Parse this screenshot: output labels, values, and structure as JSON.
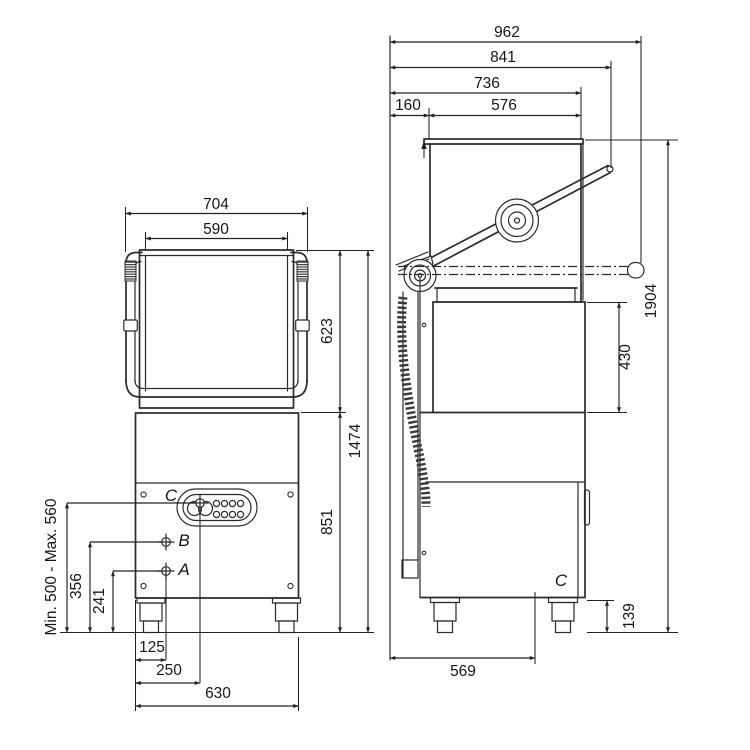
{
  "front": {
    "dim_overall_width": "704",
    "dim_hood_width": "590",
    "dim_hood_height": "623",
    "dim_total_height": "1474",
    "dim_base_height": "851",
    "dim_connection_range": "Min. 500 - Max. 560",
    "dim_b_height": "356",
    "dim_a_height": "241",
    "dim_foot_inset": "125",
    "dim_c_offset": "250",
    "dim_base_width": "630",
    "label_a": "A",
    "label_b": "B",
    "label_c": "C"
  },
  "side": {
    "dim_overall_depth": "962",
    "dim_arm_depth": "841",
    "dim_hood_front_depth": "736",
    "dim_back_clearance": "160",
    "dim_hood_depth": "576",
    "dim_opening_height": "430",
    "dim_total_height_open": "1904",
    "dim_foot_height": "139",
    "dim_drain_depth": "569",
    "label_c": "C"
  }
}
